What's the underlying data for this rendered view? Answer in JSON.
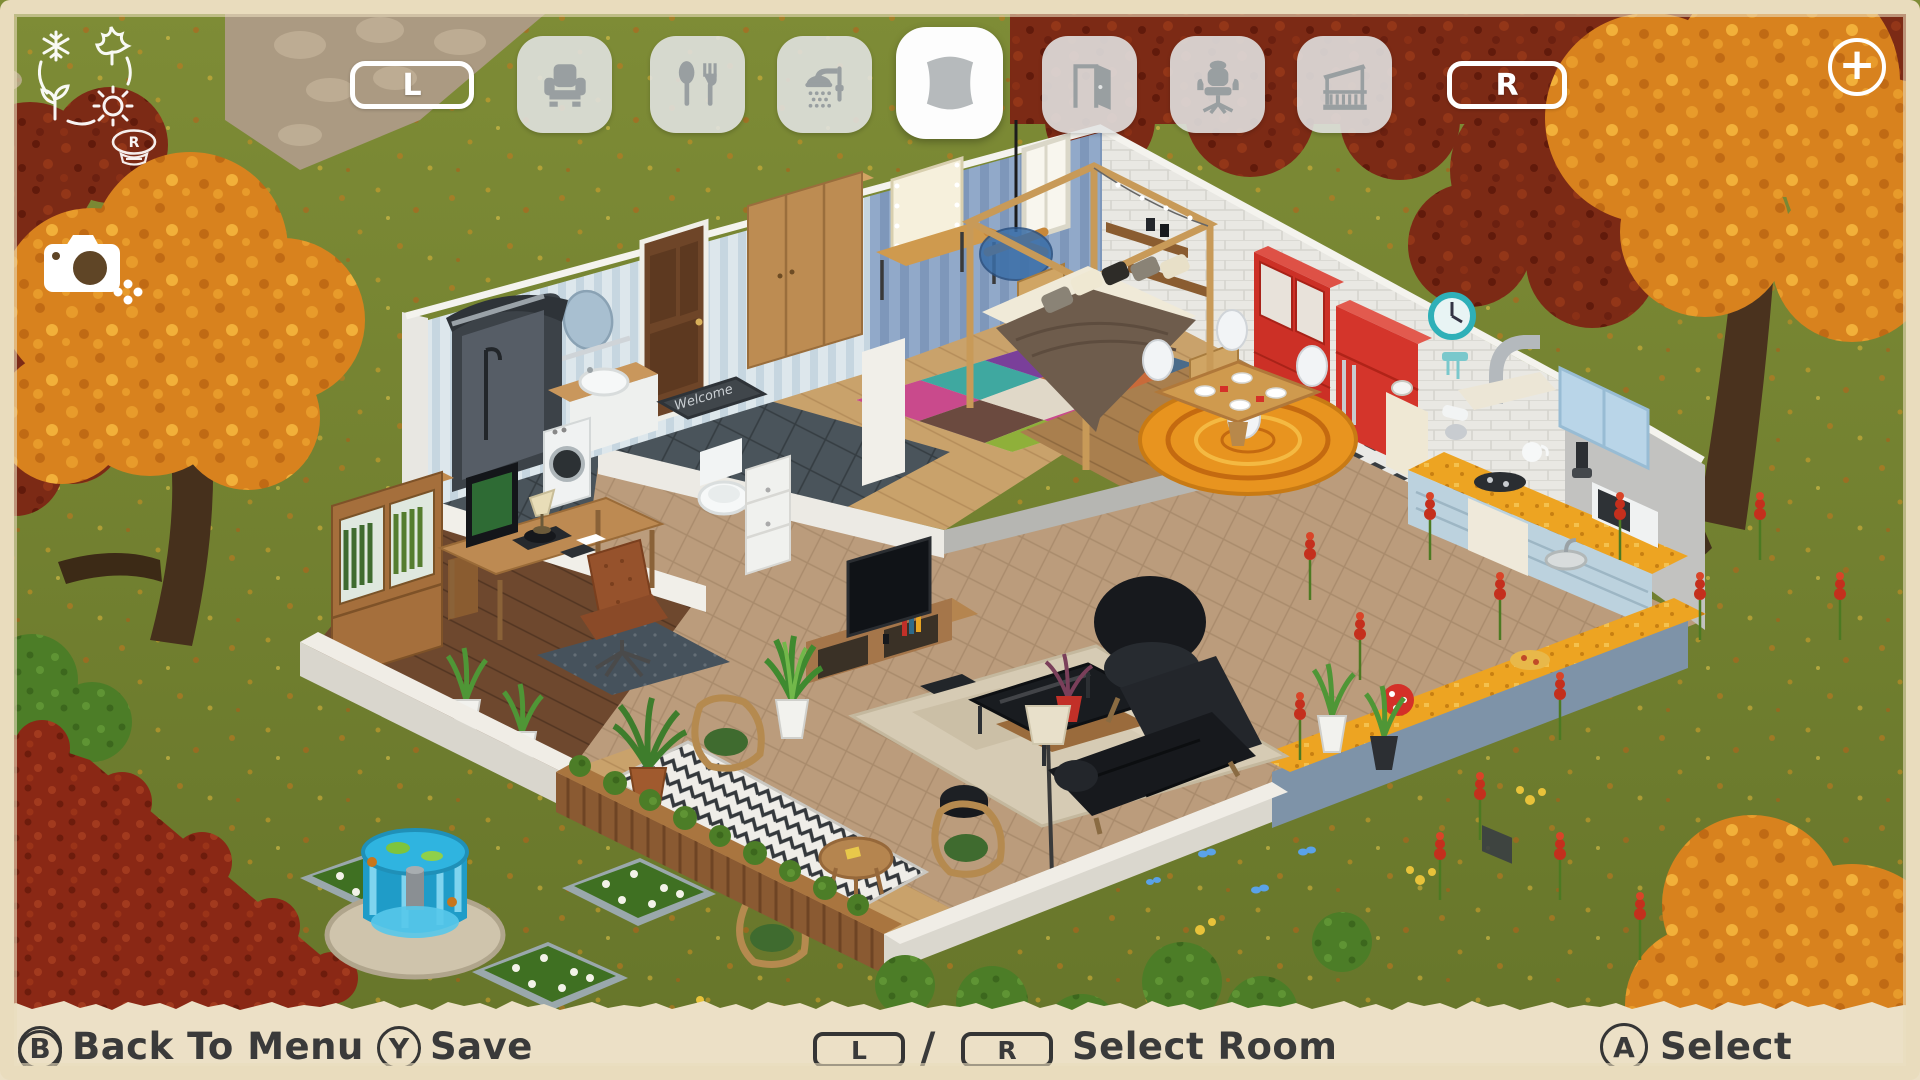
{
  "hud": {
    "season_dial": {
      "badge_label": "R",
      "icons": [
        "snowflake-icon",
        "maple-leaf-icon",
        "sprout-icon",
        "sun-icon"
      ]
    },
    "camera_icon": "camera-icon",
    "room_tabs": {
      "prev_button_label": "L",
      "next_button_label": "R",
      "add_button_label": "+",
      "tabs": [
        {
          "id": "seating",
          "icon": "armchair-icon",
          "active": false
        },
        {
          "id": "dining",
          "icon": "cutlery-icon",
          "active": false
        },
        {
          "id": "bathroom",
          "icon": "shower-icon",
          "active": false
        },
        {
          "id": "bedroom",
          "icon": "pillow-icon",
          "active": true
        },
        {
          "id": "doors",
          "icon": "door-icon",
          "active": false
        },
        {
          "id": "office",
          "icon": "office-chair-icon",
          "active": false
        },
        {
          "id": "balcony",
          "icon": "balcony-icon",
          "active": false
        }
      ]
    },
    "bottom_bar": {
      "back_button": "B",
      "back_label": "Back To Menu",
      "save_button": "Y",
      "save_label": "Save",
      "room_l": "L",
      "room_slash": "/",
      "room_r": "R",
      "room_label": "Select Room",
      "select_button": "A",
      "select_label": "Select"
    }
  },
  "scene": {
    "welcome_mat_text": "Welcome"
  },
  "colors": {
    "frame": "#e9dcbd",
    "bottom_bar_bg": "#ece0c6",
    "hud_text": "#3a3a3a",
    "tab_inactive_bg": "#e2e4e4",
    "tab_active_bg": "#fdfdfd",
    "tab_icon": "#999fa1",
    "grass": "#74832f",
    "autumn_orange": "#d8821e",
    "hedge_red": "#8a2815",
    "fountain_blue": "#2fb4e0"
  }
}
